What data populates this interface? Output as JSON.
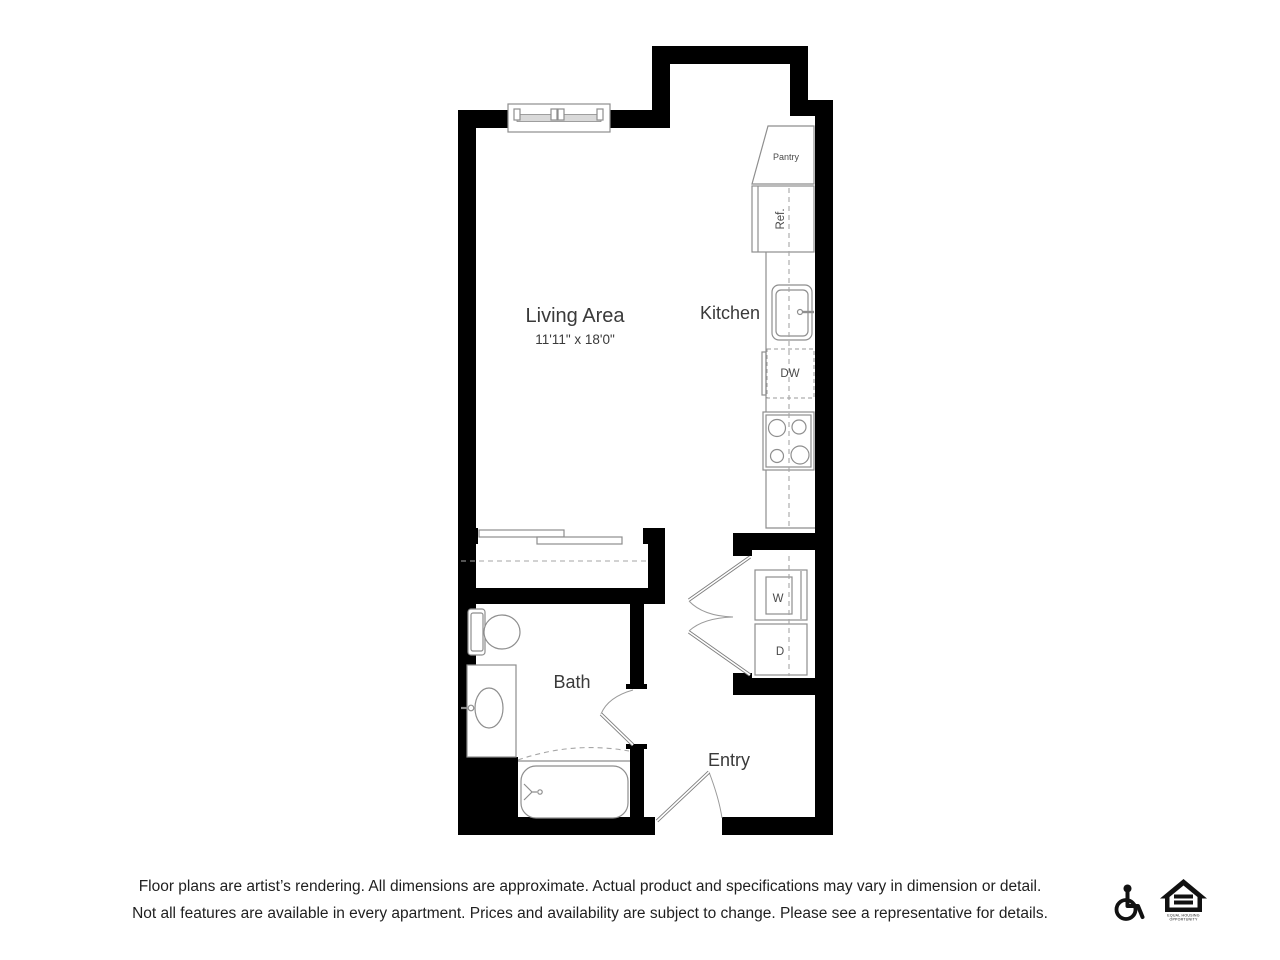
{
  "plan": {
    "rooms": {
      "living": {
        "label": "Living Area",
        "dimensions": "11'11\" x 18'0\""
      },
      "kitchen": {
        "label": "Kitchen"
      },
      "bath": {
        "label": "Bath"
      },
      "entry": {
        "label": "Entry"
      }
    },
    "fixtures": {
      "pantry_label": "Pantry",
      "refrigerator_label": "Ref.",
      "dishwasher_label": "DW",
      "washer_label": "W",
      "dryer_label": "D"
    },
    "colors": {
      "wall": "#000000",
      "fixture_line": "#8e8e8e",
      "dashed_line": "#a6a6a6",
      "room_label": "#3a3a3a"
    }
  },
  "footer": {
    "disclaimer_line1": "Floor plans are artist’s rendering. All dimensions are approximate. Actual product and specifications may vary in dimension or detail.",
    "disclaimer_line2": "Not all features are available in every apartment. Prices and availability are subject to change. Please see a representative for details.",
    "accessible_icon": "wheelchair-accessible-icon",
    "equal_housing_icon": "equal-housing-opportunity-icon",
    "equal_housing_line1": "EQUAL HOUSING",
    "equal_housing_line2": "OPPORTUNITY"
  }
}
